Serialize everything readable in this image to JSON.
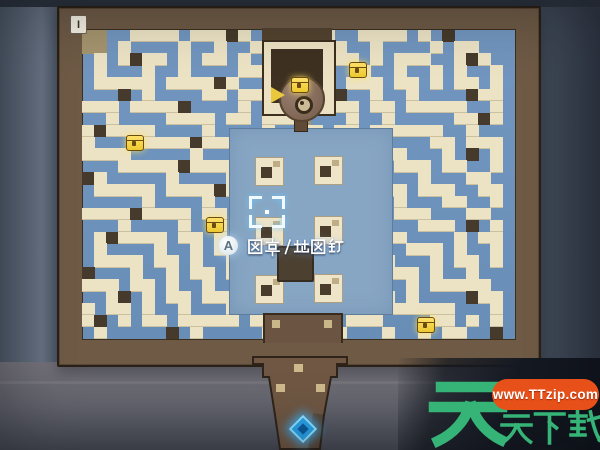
{
  "scene": {
    "type": "dungeon-maze-map-photo",
    "region_label": "I"
  },
  "palette": {
    "wall": "#ece3c5",
    "path_blue": "#6d92bb",
    "dark_block": "#453a2b",
    "tan_block": "#a4946e",
    "frame_brown": "#6e5a45",
    "frame_outline": "#2a2015",
    "platform_blue": "#87a6c3",
    "chest_gold": "#f5d43e",
    "cursor_white": "#f2faff",
    "warp_blue": "#2aa2ea",
    "watermark_green": "#36b377",
    "watermark_pill_red": "#e85019"
  },
  "maze": {
    "legend": {
      "W": "wall",
      "D": "dark",
      "T": "tan",
      ".": "path"
    },
    "rows": [
      "TT..WWWW.WWWDW...W.WW..WWWW.W.D.....",
      "TT.W....W..W..WW.WW..W..W....W.WW...",
      ".W.WDWW.W.WW.W..W..WWWW.W.WWW..WDW..",
      ".W...W..W....WW.WWD....W..W..W.W..W.",
      ".WWWWW.WWWWDW..W..WWW.WWW.WW.W.WW.W.",
      "...D.W....WW.WW.WW..WD..W..W....DWW.",
      "WWW.WWWWD....W...W.WWWW.WW.WWWWW..W.",
      "..W....WWWW.WW.WWWT...W..W.....WWDW.",
      "WDWWWW....W....W..WW.WW.WWWWWW..W...",
      "W....WWWWDWWWW.WW..W..W......WW.WWW.",
      "WWWW.....W....W..W.WW.WWWWW...W.D.W.",
      "...WWWWWDWWWW.WW.W..W.....WWW.WW..W.",
      "DW.....W....W..W.WW.WWWWW...W...WW..",
      ".WWWWW.WWWWDWW.W..W.....WWW.WWW..WW.",
      ".....W....W..W.WW.WWWWW...W...WW..W.",
      "WWWWDWWWW.WW.W..W.....WWW.WWW...WW..",
      "...W....W..W.WW.WWWWW...W...WWW.D.W.",
      ".WDWWWW.WW.W..W.....WWW.WWW....W.WW.",
      ".W....W..W.WWDW.WWWW....W..WWW.W..W.",
      ".WWWW.WW.W..W...W...WWW.WW...W.WW.W.",
      "D...W..W.WW.WWW.WWW...W..WWW.W..W...",
      "WWW.WW.W..W...W...WWW.WW...W.WWWWW..",
      "..WD.W.WW.WWW.WWW...W..WWW.W....DWW.",
      "W.WW.W..W...W..WWWW.WW...WWWWWW...W.",
      "WD.W.WW.WWWWW.W....W..WWW....WW.W.W.",
      ".W.....D.W.....WWW.WWW...W..W.WW..D."
    ]
  },
  "platform": {
    "blocks": [
      {
        "x": 255,
        "y": 157
      },
      {
        "x": 314,
        "y": 156
      },
      {
        "x": 255,
        "y": 217
      },
      {
        "x": 314,
        "y": 216
      },
      {
        "x": 255,
        "y": 275
      },
      {
        "x": 314,
        "y": 274
      }
    ]
  },
  "markers": {
    "chests": [
      {
        "x": 126,
        "y": 135
      },
      {
        "x": 349,
        "y": 62
      },
      {
        "x": 206,
        "y": 217
      },
      {
        "x": 417,
        "y": 317
      },
      {
        "x": 291,
        "y": 77
      }
    ],
    "cursor": {
      "x": 249,
      "y": 196,
      "w": 36,
      "h": 32
    },
    "warp_entrance": {
      "x": 293,
      "y": 419
    }
  },
  "hint": {
    "button": "A",
    "label": "图章/地图钉"
  },
  "watermark": {
    "logo_char": "天",
    "brand": "天天下载",
    "url": "www.TTzip.com"
  }
}
